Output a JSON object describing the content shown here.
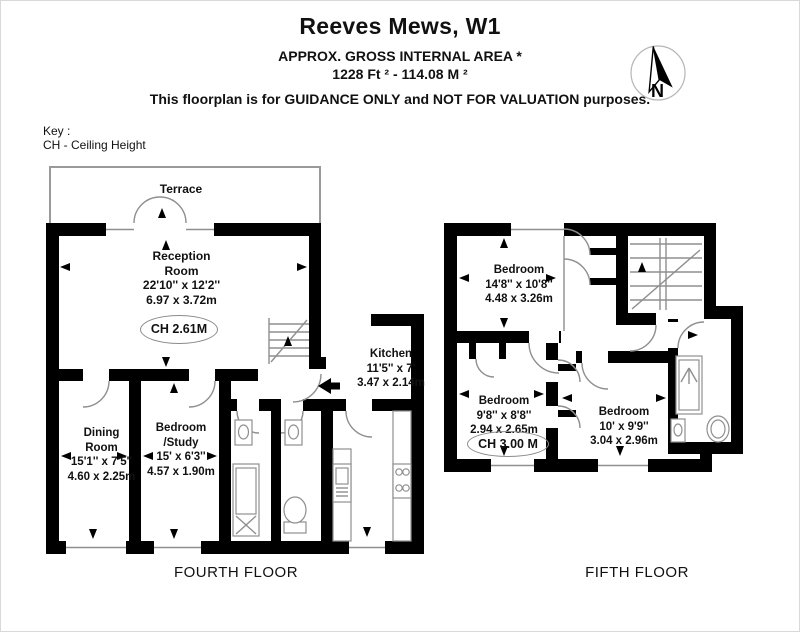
{
  "header": {
    "title": "Reeves Mews, W1",
    "subtitle": "APPROX. GROSS INTERNAL  AREA *",
    "area_line": "1228 Ft ²  -  114.08 M ²",
    "disclaimer": "This floorplan is for GUIDANCE ONLY and NOT FOR VALUATION purposes.",
    "compass_letter": "N"
  },
  "key": {
    "title": "Key :",
    "entry": "CH - Ceiling Height"
  },
  "fourth_floor": {
    "floor_label": "FOURTH FLOOR",
    "terrace": "Terrace",
    "reception": "Reception\nRoom\n22'10'' x 12'2''\n6.97 x 3.72m",
    "reception_ch": "CH 2.61M",
    "kitchen": "Kitchen\n11'5'' x 7'\n3.47 x 2.14m",
    "dining": "Dining\nRoom\n15'1'' x 7'5''\n4.60 x 2.25m",
    "bedroom_study": "Bedroom\n/Study\n15' x 6'3''\n4.57 x 1.90m"
  },
  "fifth_floor": {
    "floor_label": "FIFTH FLOOR",
    "bedroom_1": "Bedroom\n14'8'' x 10'8''\n4.48 x 3.26m",
    "bedroom_2": "Bedroom\n9'8'' x 8'8''\n2.94 x 2.65m",
    "bedroom_2_ch": "CH 3.00 M",
    "bedroom_3": "Bedroom\n10' x 9'9''\n3.04 x 2.96m"
  },
  "colors": {
    "wall": "#000000",
    "thin_line": "#8f8f8f",
    "background": "#ffffff"
  }
}
